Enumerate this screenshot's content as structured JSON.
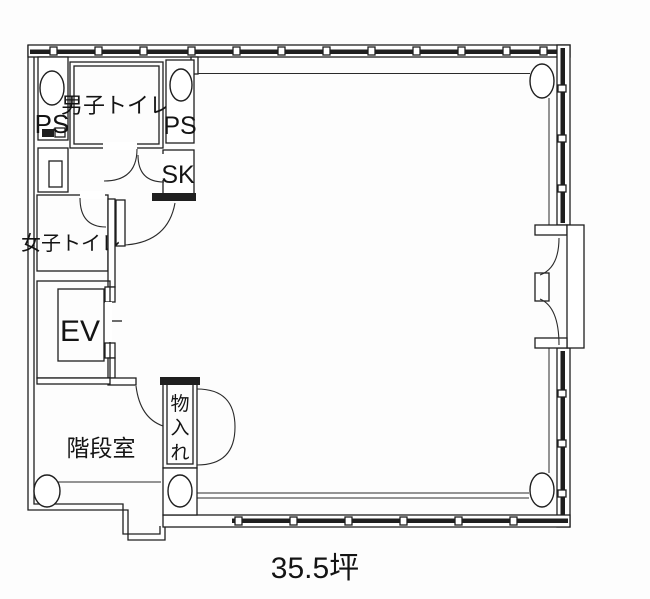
{
  "document": {
    "type": "floor-plan-scan",
    "area_label": "35.5坪"
  },
  "rooms": {
    "ps_left": {
      "label": "PS"
    },
    "ps_right": {
      "label": "PS"
    },
    "mens_toilet": {
      "label": "男子トイレ"
    },
    "sk": {
      "label": "SK"
    },
    "womens_toilet": {
      "label": "女子トイレ"
    },
    "elevator": {
      "label": "EV"
    },
    "staircase": {
      "label": "階段室"
    },
    "storage": {
      "label": "物入れ",
      "chars": [
        "物",
        "入",
        "れ"
      ]
    }
  },
  "colors": {
    "line": "#1f1f1f",
    "paper": "#ffffff"
  }
}
